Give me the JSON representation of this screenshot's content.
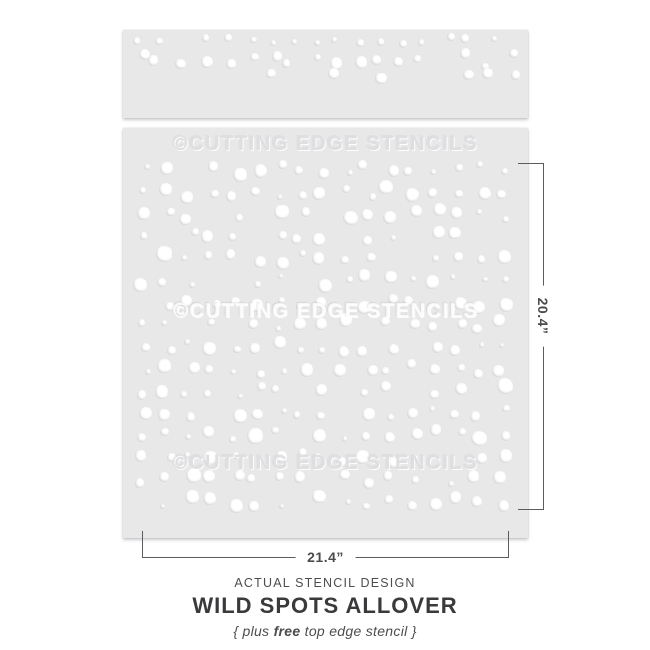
{
  "product": {
    "brand_watermark": "©CUTTING EDGE STENCILS",
    "dimensions": {
      "height_label": "20.4”",
      "width_label": "21.4”"
    },
    "caption": {
      "kicker": "ACTUAL STENCIL DESIGN",
      "title": "WILD SPOTS ALLOVER",
      "tagline_prefix": "{ plus ",
      "tagline_bold": "free",
      "tagline_suffix": " top edge stencil }"
    }
  },
  "colors": {
    "background": "#ffffff",
    "sheet": "#e8e8e9",
    "spot": "#ffffff",
    "dimension_line": "#5a5c5e",
    "dimension_text": "#4b4b4d",
    "title_text": "#3a3a3c",
    "secondary_text": "#4d4d4f",
    "watermark_embossed": "#dfdfe1"
  },
  "pattern": {
    "seed": 20417,
    "main": {
      "cols": 17,
      "x0": 22,
      "dx": 22.25,
      "rows": 16,
      "y0": 42,
      "dy": 22.1,
      "jitter": 6,
      "r_min": 2.6,
      "r_max": 7.2,
      "big_chance": 0.08,
      "skip": 0.11
    },
    "strip": {
      "cols": 18,
      "x0": 16,
      "dx": 22,
      "row_defs": [
        {
          "y": 10,
          "jitter": 5,
          "r_min": 2.6,
          "r_max": 4.6,
          "skip": 0.22
        },
        {
          "y": 30,
          "jitter": 8,
          "r_min": 3.4,
          "r_max": 6.4,
          "skip": 0.12
        },
        {
          "y": 46,
          "jitter": 4,
          "r_min": 4.6,
          "r_max": 6.8,
          "skip": 0.72
        }
      ]
    }
  }
}
